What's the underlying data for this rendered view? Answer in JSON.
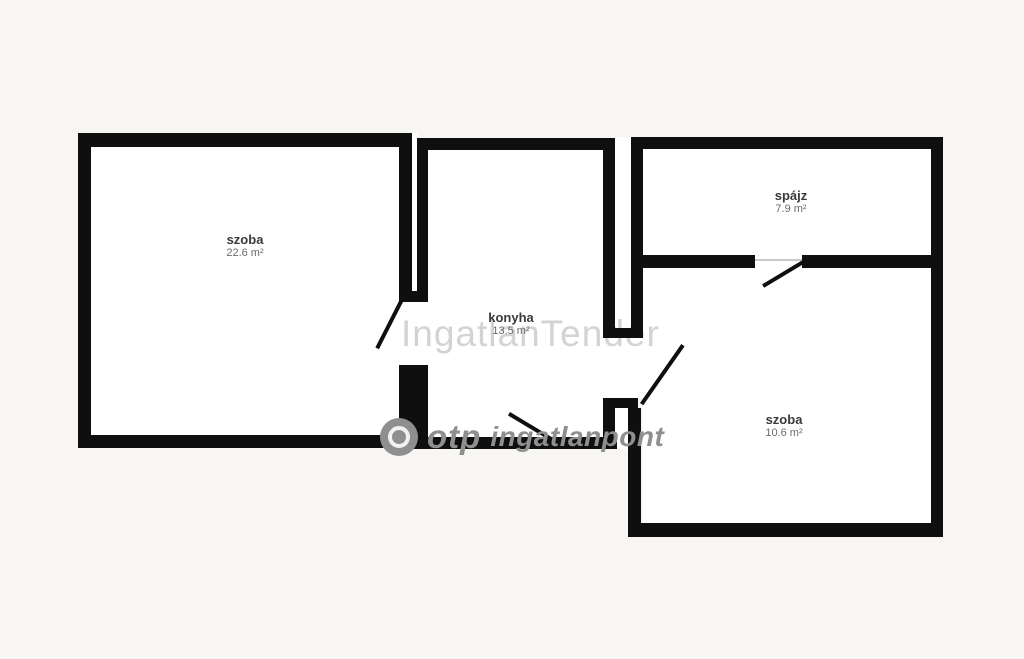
{
  "plan": {
    "rooms": [
      {
        "id": "szoba-left",
        "label": "szoba",
        "area": "22.6 m²"
      },
      {
        "id": "konyha",
        "label": "konyha",
        "area": "13.5 m²"
      },
      {
        "id": "spajz",
        "label": "spájz",
        "area": "7.9 m²"
      },
      {
        "id": "szoba-right",
        "label": "szoba",
        "area": "10.6 m²"
      }
    ],
    "colors": {
      "background": "#f7f6f3",
      "wall": "#0f0f0f",
      "room_fill": "#ffffff",
      "watermark_light": "#d9d8d4",
      "watermark_gray": "#8f8f8f"
    }
  },
  "watermarks": {
    "center_text": "IngatlanTender",
    "brand_name": "otp",
    "brand_suffix": "ingatlanpont"
  }
}
